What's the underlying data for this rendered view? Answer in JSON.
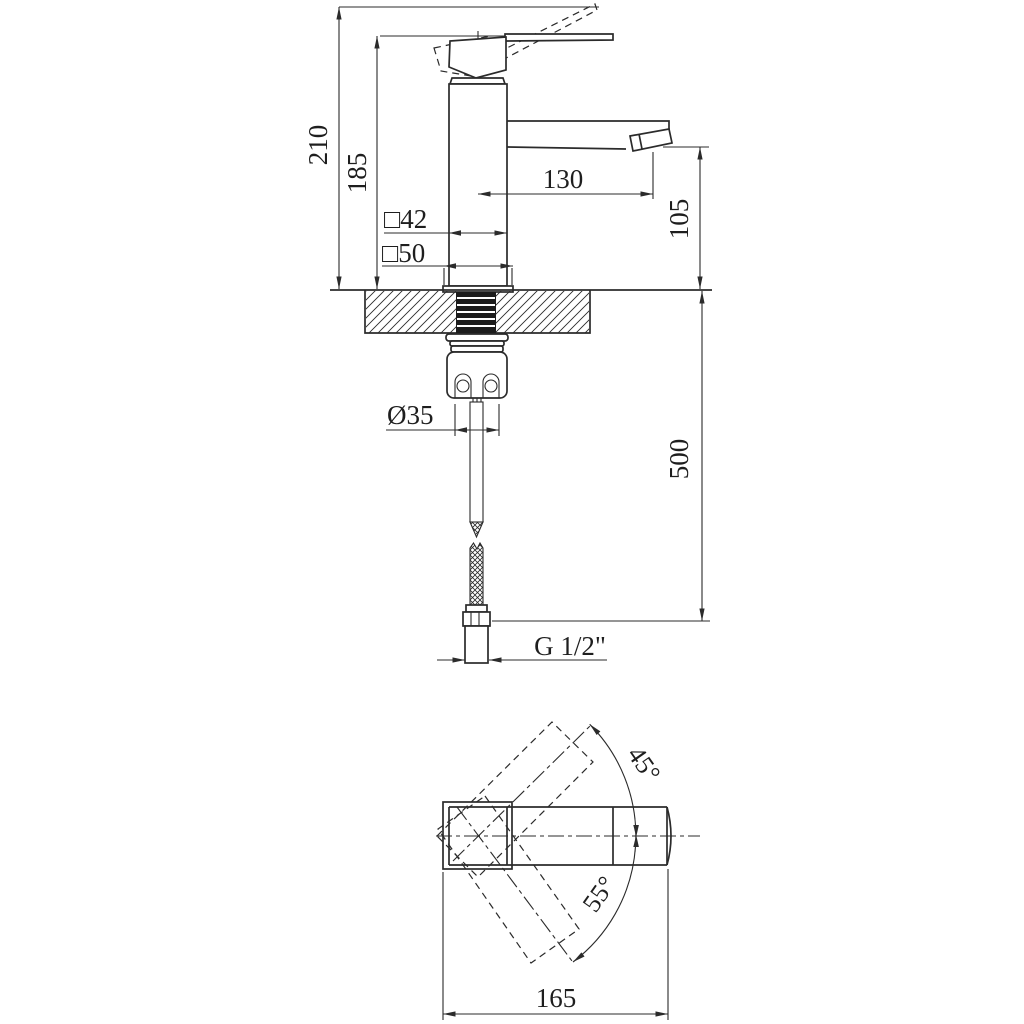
{
  "drawing_title": "single-lever-basin-faucet-dimensional-drawing",
  "front_view": {
    "height_overall": "210",
    "height_to_lever": "185",
    "spout_reach": "130",
    "spout_outlet_height": "105",
    "body_square_section": "□42",
    "base_square_section": "□50",
    "mounting_hole_diameter": "Ø35",
    "hose_length": "500",
    "connection_thread": "G 1/2\""
  },
  "top_view": {
    "handle_angle_up": "45°",
    "handle_angle_down": "55°",
    "length_overall": "165"
  },
  "colors": {
    "line": "#2b2b2b",
    "background": "#ffffff",
    "thread_fill": "#1c1c1c"
  }
}
